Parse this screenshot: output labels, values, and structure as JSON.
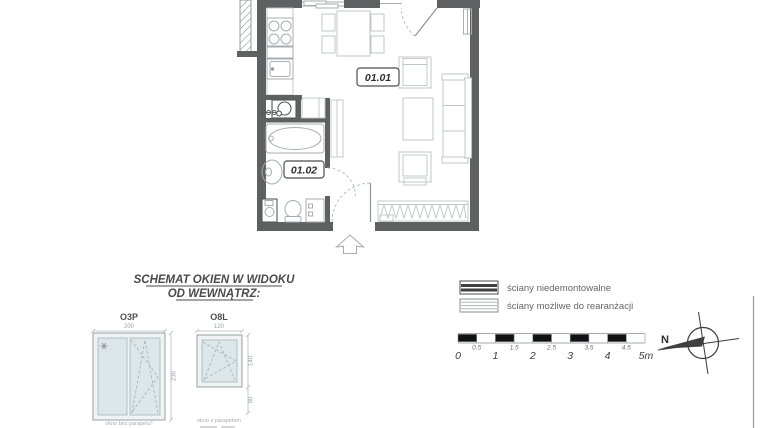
{
  "plan": {
    "rooms": [
      {
        "label": "01.01"
      },
      {
        "label": "01.02"
      }
    ]
  },
  "window_schematic": {
    "title_line1": "SCHEMAT OKIEN W WIDOKU",
    "title_line2": "OD WEWNĄTRZ:",
    "windows": [
      {
        "name": "O3P",
        "width_cm": "200",
        "height_cm": "230",
        "caption": "okno bez parapetu*"
      },
      {
        "name": "O8L",
        "width_cm": "120",
        "height_cm": "140",
        "sill_height_cm": "90",
        "caption": "okno z parapetem"
      }
    ]
  },
  "legend": {
    "items": [
      {
        "swatch": "dark-striped-wall",
        "label": "ściany niedemontowalne"
      },
      {
        "swatch": "light-striped-wall",
        "label": "ściany możliwe do rearanżacji"
      }
    ]
  },
  "scale_bar": {
    "major_labels": [
      "0",
      "1",
      "2",
      "3",
      "4",
      "5m"
    ],
    "minor_labels": [
      "0.5",
      "1.5",
      "2.5",
      "3.5",
      "4.5"
    ]
  },
  "compass": {
    "north_label": "N"
  },
  "colors": {
    "wall": "#5e6062",
    "furniture_line": "#c0c5c7",
    "fixture_line": "#a7adb0",
    "window_pane_fill": "#dde7ea",
    "text_dark": "#4a4a4a",
    "text_gray": "#6b6b6b",
    "scale_black": "#111111"
  }
}
